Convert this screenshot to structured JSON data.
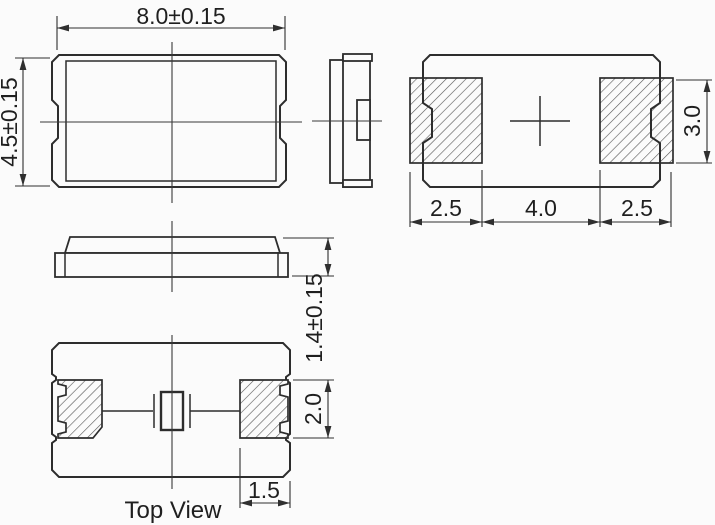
{
  "drawing": {
    "background_color": "#fbfbfb",
    "line_color": "#2d2d2d",
    "hatch_color": "#555555",
    "views": {
      "plan": {
        "body_width": "8.0±0.15",
        "body_height": "4.5±0.15"
      },
      "land_pattern": {
        "left_pad_width": "2.5",
        "pad_gap": "4.0",
        "right_pad_width": "2.5",
        "pad_height": "3.0"
      },
      "front": {
        "body_thickness": "1.4±0.15"
      },
      "top": {
        "label": "Top View",
        "electrode_length": "2.0",
        "electrode_width": "1.5"
      }
    }
  }
}
